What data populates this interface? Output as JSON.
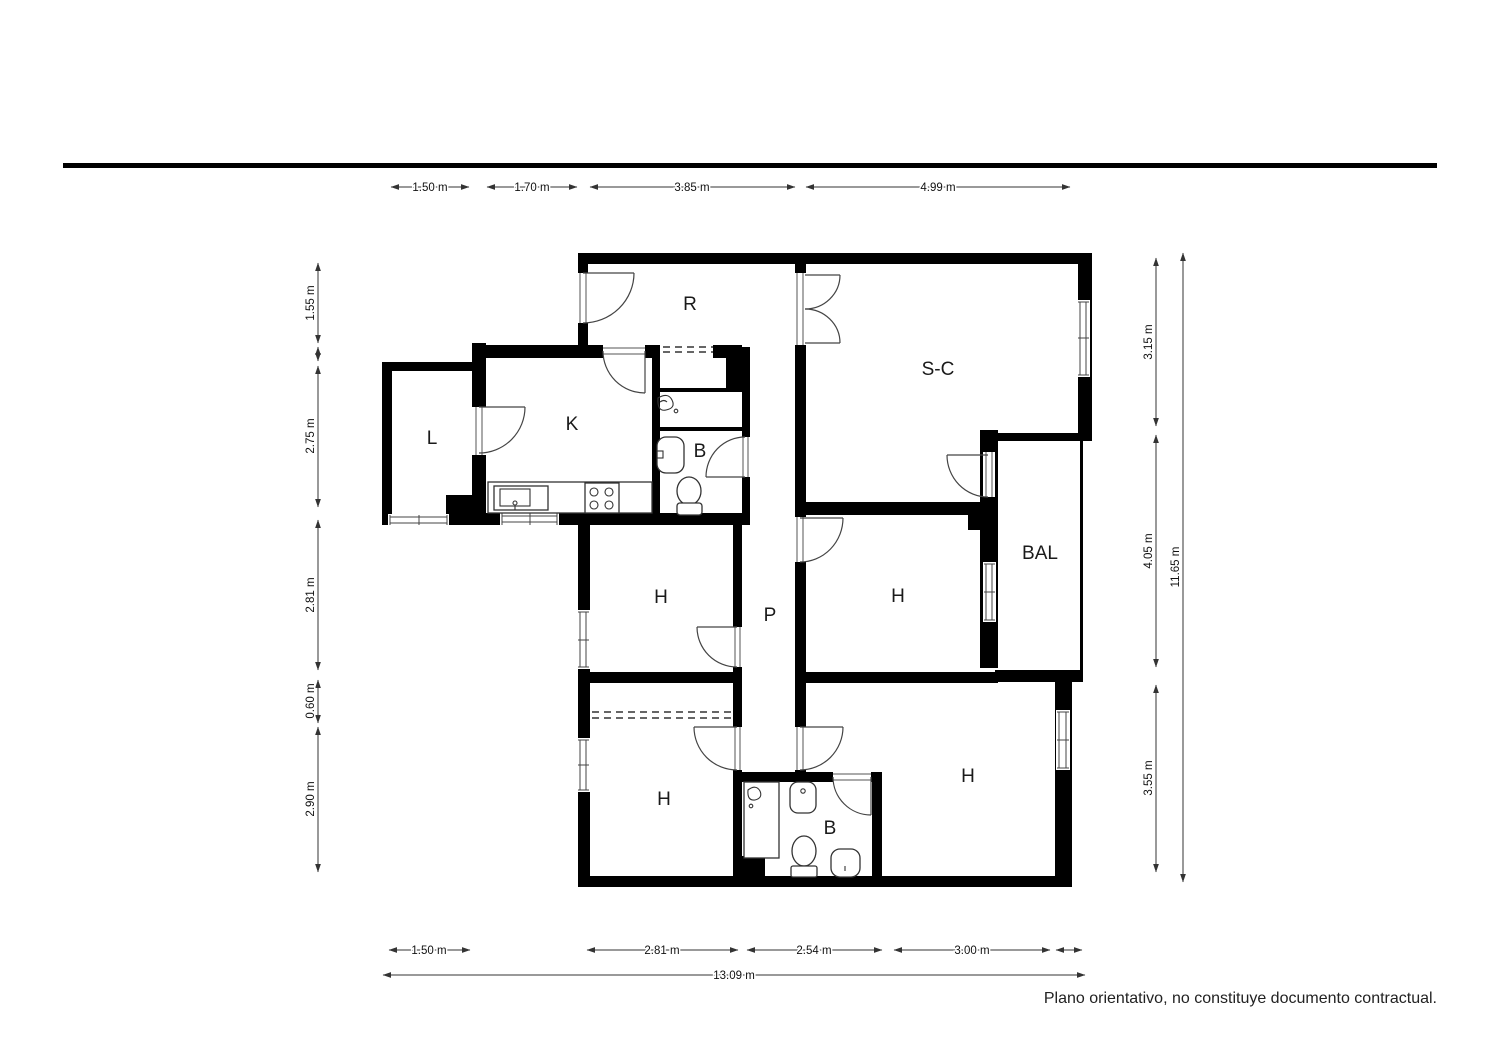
{
  "meta": {
    "type": "floor-plan",
    "wall_color": "#000000",
    "background": "#ffffff",
    "line_color": "#333333"
  },
  "rooms": {
    "hall": "R",
    "living": "S-C",
    "kitchen": "K",
    "laundry": "L",
    "bath1": "B",
    "balcony": "BAL",
    "bedroom_mid_left": "H",
    "corridor": "P",
    "bedroom_mid_right": "H",
    "bedroom_low_left": "H",
    "bath2": "B",
    "bedroom_low_right": "H"
  },
  "dimensions": {
    "top": [
      "1.50 m",
      "1.70 m",
      "3.85 m",
      "4.99 m"
    ],
    "left": [
      "1.55 m",
      "2.75 m",
      "2.81 m",
      "0.60 m",
      "2.90 m"
    ],
    "right": [
      "3.15 m",
      "4.05 m",
      "3.55 m"
    ],
    "right_total": "11.65 m",
    "bottom": [
      "1.50 m",
      "2.81 m",
      "2.54 m",
      "3.00 m"
    ],
    "bottom_total": "13.09 m"
  },
  "fixtures": [
    "stove",
    "kitchen-sink",
    "washbasin",
    "toilet",
    "shower",
    "bidet"
  ],
  "disclaimer": "Plano orientativo, no constituye documento contractual."
}
